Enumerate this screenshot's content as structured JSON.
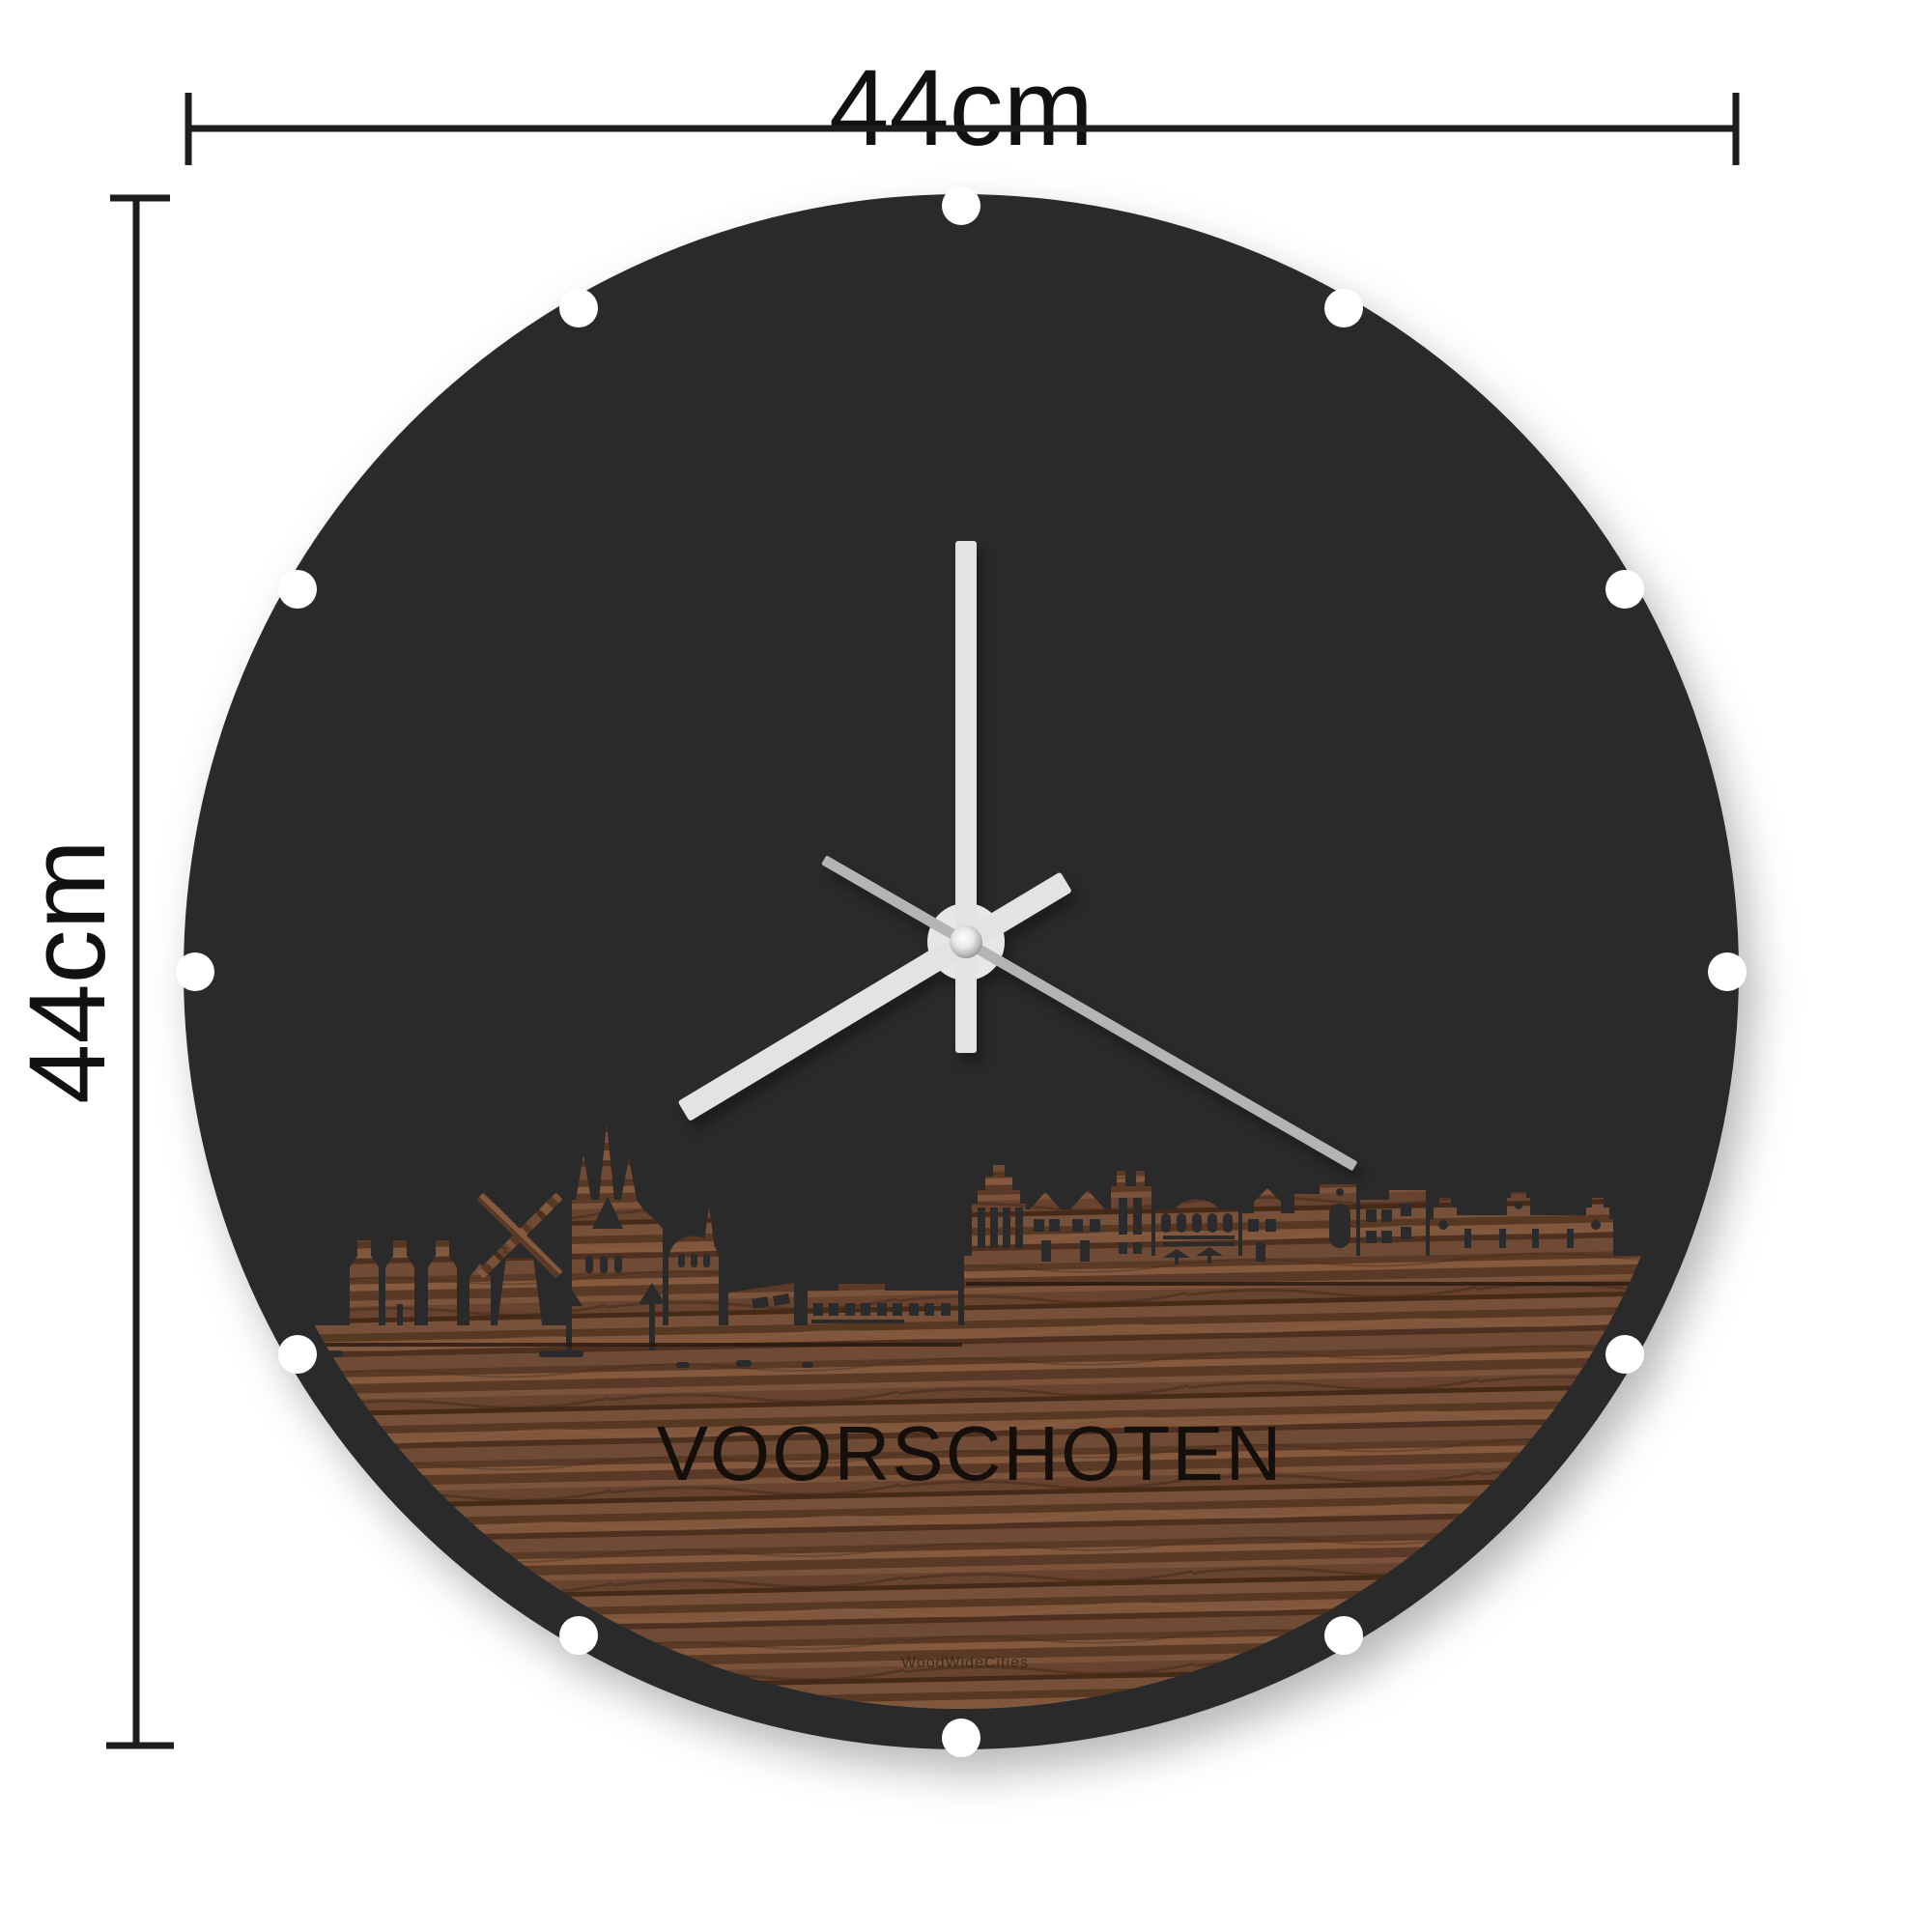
{
  "product": {
    "type": "round skyline wall clock with dimension arrows",
    "dimensions": {
      "width_label": "44cm",
      "height_label": "44cm"
    }
  },
  "clock": {
    "city_label": "VOORSCHOTEN",
    "brand_label": "WoodWideCities",
    "skyline": "Voorschoten silhouette: houses, windmill, church with spires, step-gable houses, castle row cut from walnut wood",
    "time": {
      "hour_deg": 239,
      "minute_deg": 0,
      "second_deg": 120
    },
    "notch_count": 12
  },
  "colors": {
    "background": "#ffffff",
    "disc": "#2b2b2b",
    "dimension_lines": "#1d1d1d",
    "hand_light": "#e3e3e2",
    "hand_second": "#b4b4b4",
    "hub_plate": "#e7e7e5",
    "wood_base": "#6b4832",
    "wood_dark_streak": "#462a18",
    "wood_light_streak": "#8a5f41",
    "engraving": "#140f0a"
  }
}
